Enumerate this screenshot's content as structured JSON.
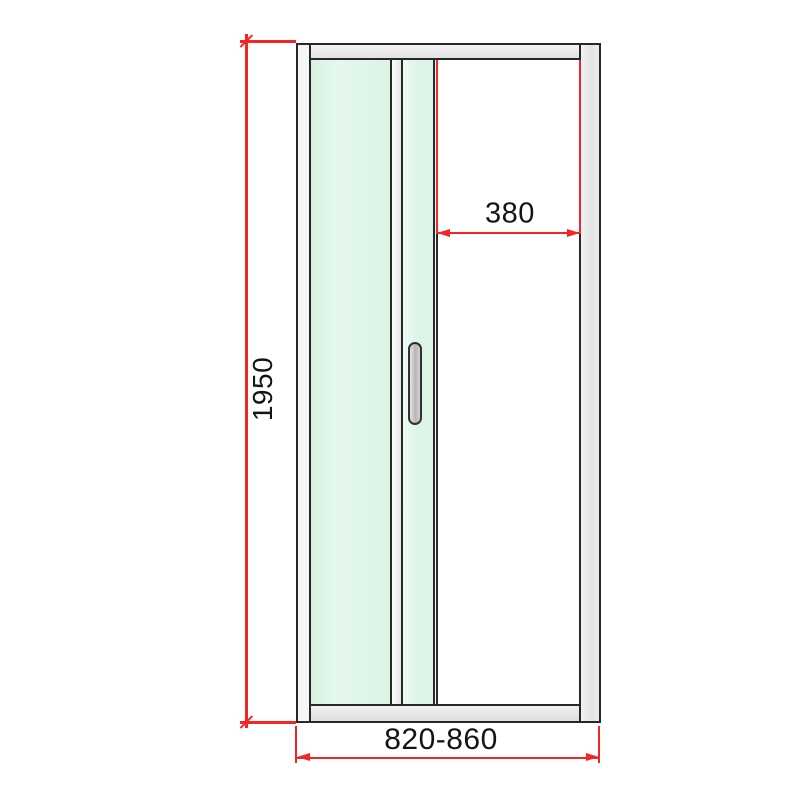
{
  "diagram": {
    "subject": "shower-door-technical-drawing",
    "dimensions": {
      "height": "1950",
      "entry_width": "380",
      "overall_width": "820-860"
    },
    "colors": {
      "dimension_red": "#f32525",
      "outline_dark": "#282828",
      "frame_aluminum": "#e8e8e8",
      "glass_mint": "#def4e7",
      "background": "#ffffff"
    }
  }
}
